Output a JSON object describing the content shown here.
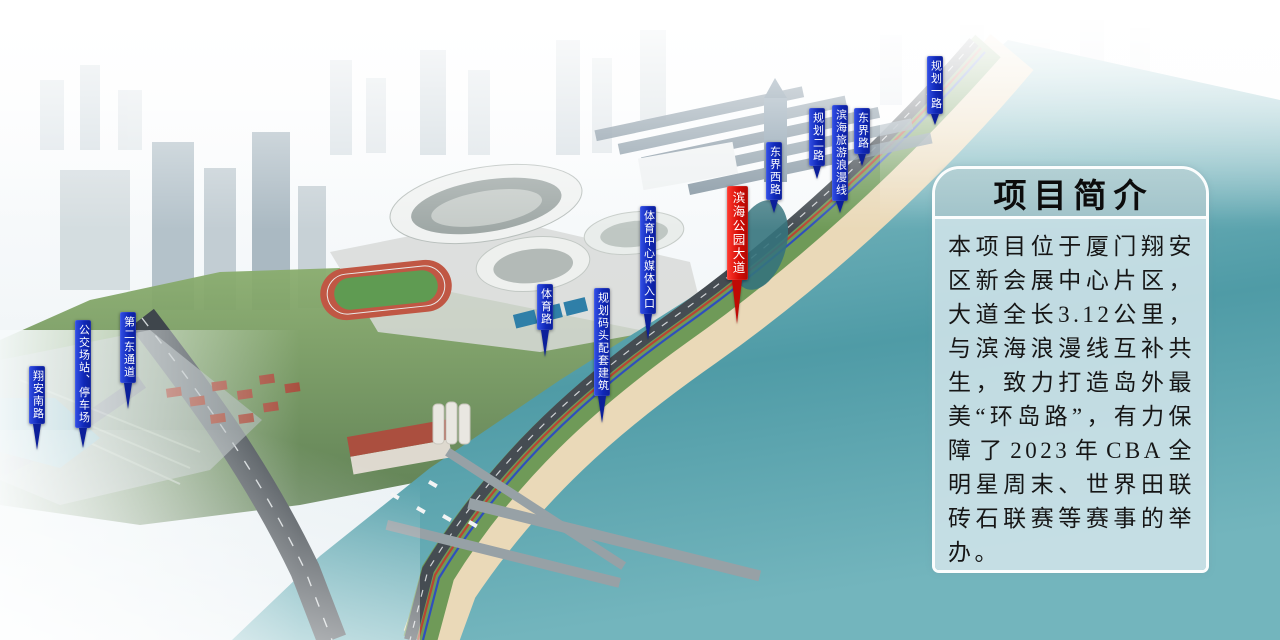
{
  "panel": {
    "title": "项目简介",
    "body": "本项目位于厦门翔安区新会展中心片区，大道全长3.12公里，与滨海浪漫线互补共生，致力打造岛外最美“环岛路”，有力保障了2023年CBA全明星周末、世界田联砖石联赛等赛事的举办。"
  },
  "map_labels": [
    {
      "id": "xiangan-south-road",
      "text": "翔安南路",
      "color": "blue"
    },
    {
      "id": "bus-station-parking",
      "text": "公交场站、停车场",
      "color": "blue"
    },
    {
      "id": "second-east-corridor",
      "text": "第二东通道",
      "color": "blue"
    },
    {
      "id": "sports-road",
      "text": "体育路",
      "color": "blue"
    },
    {
      "id": "planned-wharf-buildings",
      "text": "规划码头配套建筑",
      "color": "blue"
    },
    {
      "id": "sports-center-media-entrance",
      "text": "体育中心媒体入口",
      "color": "blue"
    },
    {
      "id": "binhai-park-avenue",
      "text": "滨海公园大道",
      "color": "red"
    },
    {
      "id": "dongjie-west-road",
      "text": "东界西路",
      "color": "blue"
    },
    {
      "id": "planned-road-2",
      "text": "规划二路",
      "color": "blue"
    },
    {
      "id": "binhai-tourism-romantic-line",
      "text": "滨海旅游浪漫线",
      "color": "blue"
    },
    {
      "id": "dongjie-road",
      "text": "东界路",
      "color": "blue"
    },
    {
      "id": "planned-road-1",
      "text": "规划一路",
      "color": "blue"
    }
  ],
  "colors": {
    "label_blue": "#1028b8",
    "label_red": "#d60d06",
    "panel_header": "#a8c9ce",
    "panel_body": "#d0e4e9",
    "sea": "#57a2ab",
    "sand": "#ead9b8",
    "greenbelt": "#6f9a58",
    "road": "#454c52"
  }
}
